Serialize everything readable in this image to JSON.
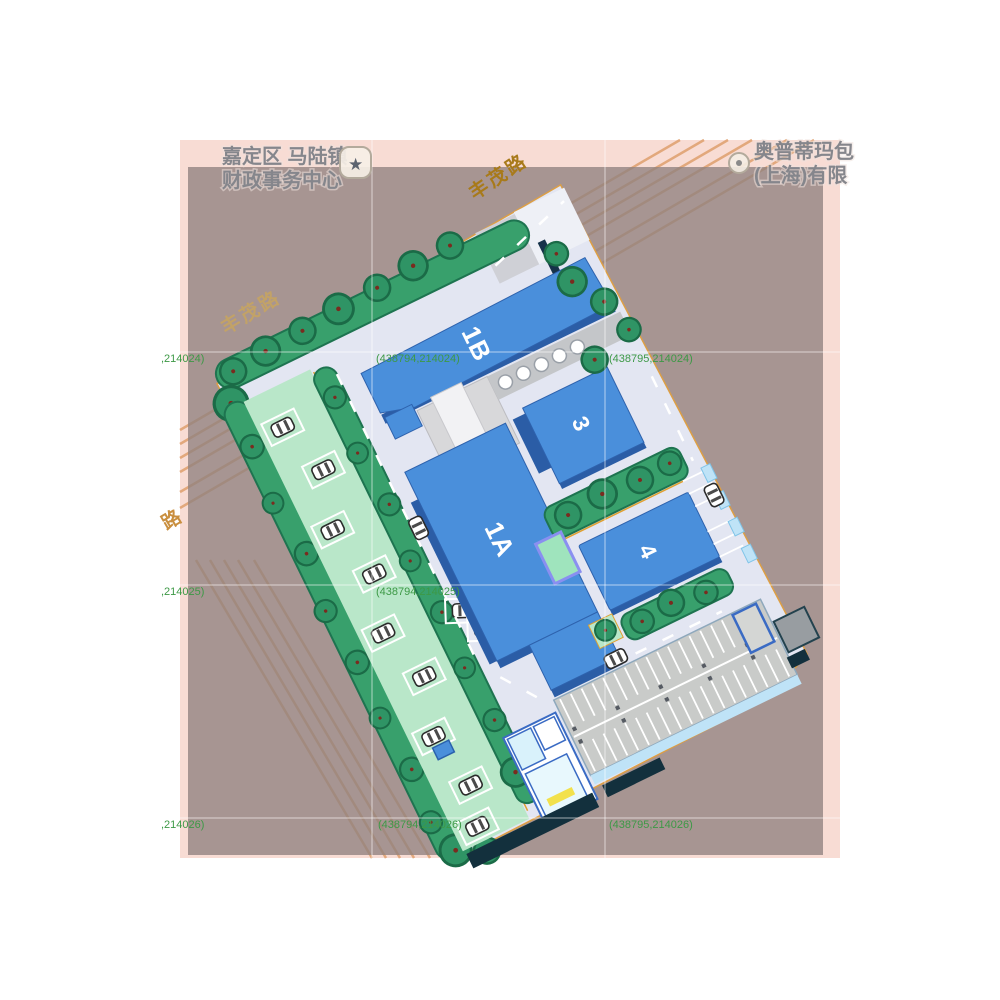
{
  "map": {
    "pois": [
      {
        "line1": "嘉定区 马陆镇",
        "line2": "财政事务中心",
        "icon": "star-badge-icon",
        "star_glyph": "★"
      },
      {
        "line1": "奥普蒂玛包",
        "line2": "(上海)有限",
        "icon": "circle-poi-icon"
      }
    ],
    "road_labels": [
      {
        "text": "丰茂路",
        "position": "top"
      },
      {
        "text": "丰茂路",
        "position": "left"
      },
      {
        "text": "路",
        "position": "left-edge"
      }
    ],
    "coordinate_labels": [
      {
        "text": "(438794,214024)"
      },
      {
        "text": "(438795,214024)"
      },
      {
        "text": ",214024)"
      },
      {
        "text": "(438794,214025)"
      },
      {
        "text": ",214025)"
      },
      {
        "text": "(438794,214026)"
      },
      {
        "text": "(438795,214026)"
      },
      {
        "text": ",214026)"
      }
    ],
    "colors": {
      "map_background": "#f8dcd4",
      "overlay": "#a89894",
      "road_line": "#e2a87c",
      "grid_label_green": "#3d9946",
      "road_label_gold": "#a87a1a"
    }
  },
  "site_plan": {
    "buildings": [
      {
        "label": "1B"
      },
      {
        "label": "1A"
      },
      {
        "label": "3"
      },
      {
        "label": "4"
      }
    ],
    "colors": {
      "building_blue": "#4a8fdb",
      "building_shadow": "#2b5da6",
      "paving": "#e3e6f2",
      "lawn": "#b9e7c9",
      "hedge_green": "#38a06c",
      "parking_gray": "#c9cbc9",
      "water": "#9fe4bd",
      "accent_blue": "#3a6bc4",
      "light_blue": "#bfe3f7",
      "navy": "#13303d",
      "yellow": "#f2e14c"
    }
  }
}
